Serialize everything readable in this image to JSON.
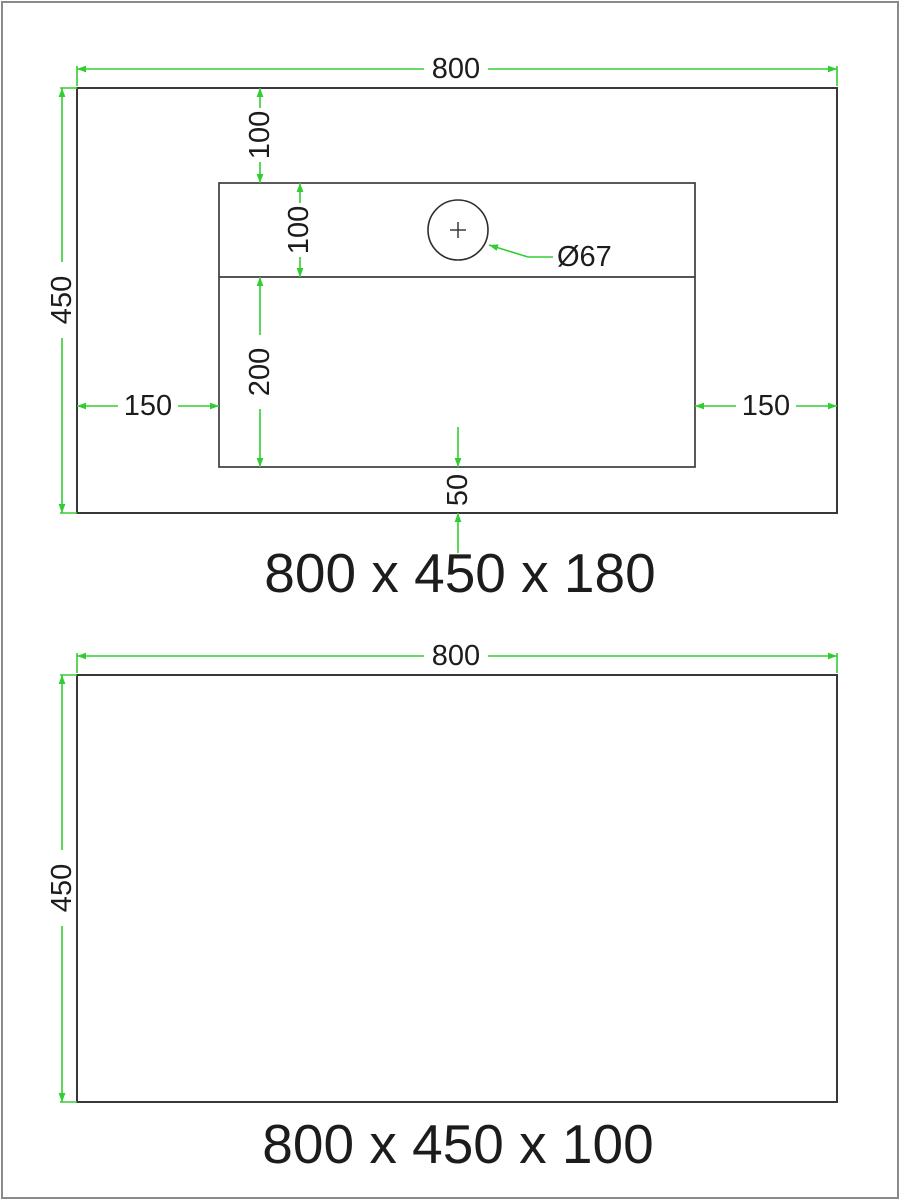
{
  "page": {
    "background": "#ffffff",
    "frame_color": "#8a8a8a"
  },
  "colors": {
    "dimension_green": "#32cd32",
    "outline_dark": "#383838",
    "text_dark": "#1c1c1c"
  },
  "top_drawing": {
    "caption": "800 x 450 x 180",
    "width_label": "800",
    "height_label": "450",
    "hole_top_offset_label": "100",
    "hole_band_height_label": "100",
    "basin_lower_height_label": "200",
    "left_inset_label": "150",
    "right_inset_label": "150",
    "bottom_gap_label": "50",
    "hole_diameter_label": "Ø67"
  },
  "bottom_drawing": {
    "caption": "800 x 450 x 100",
    "width_label": "800",
    "height_label": "450"
  }
}
